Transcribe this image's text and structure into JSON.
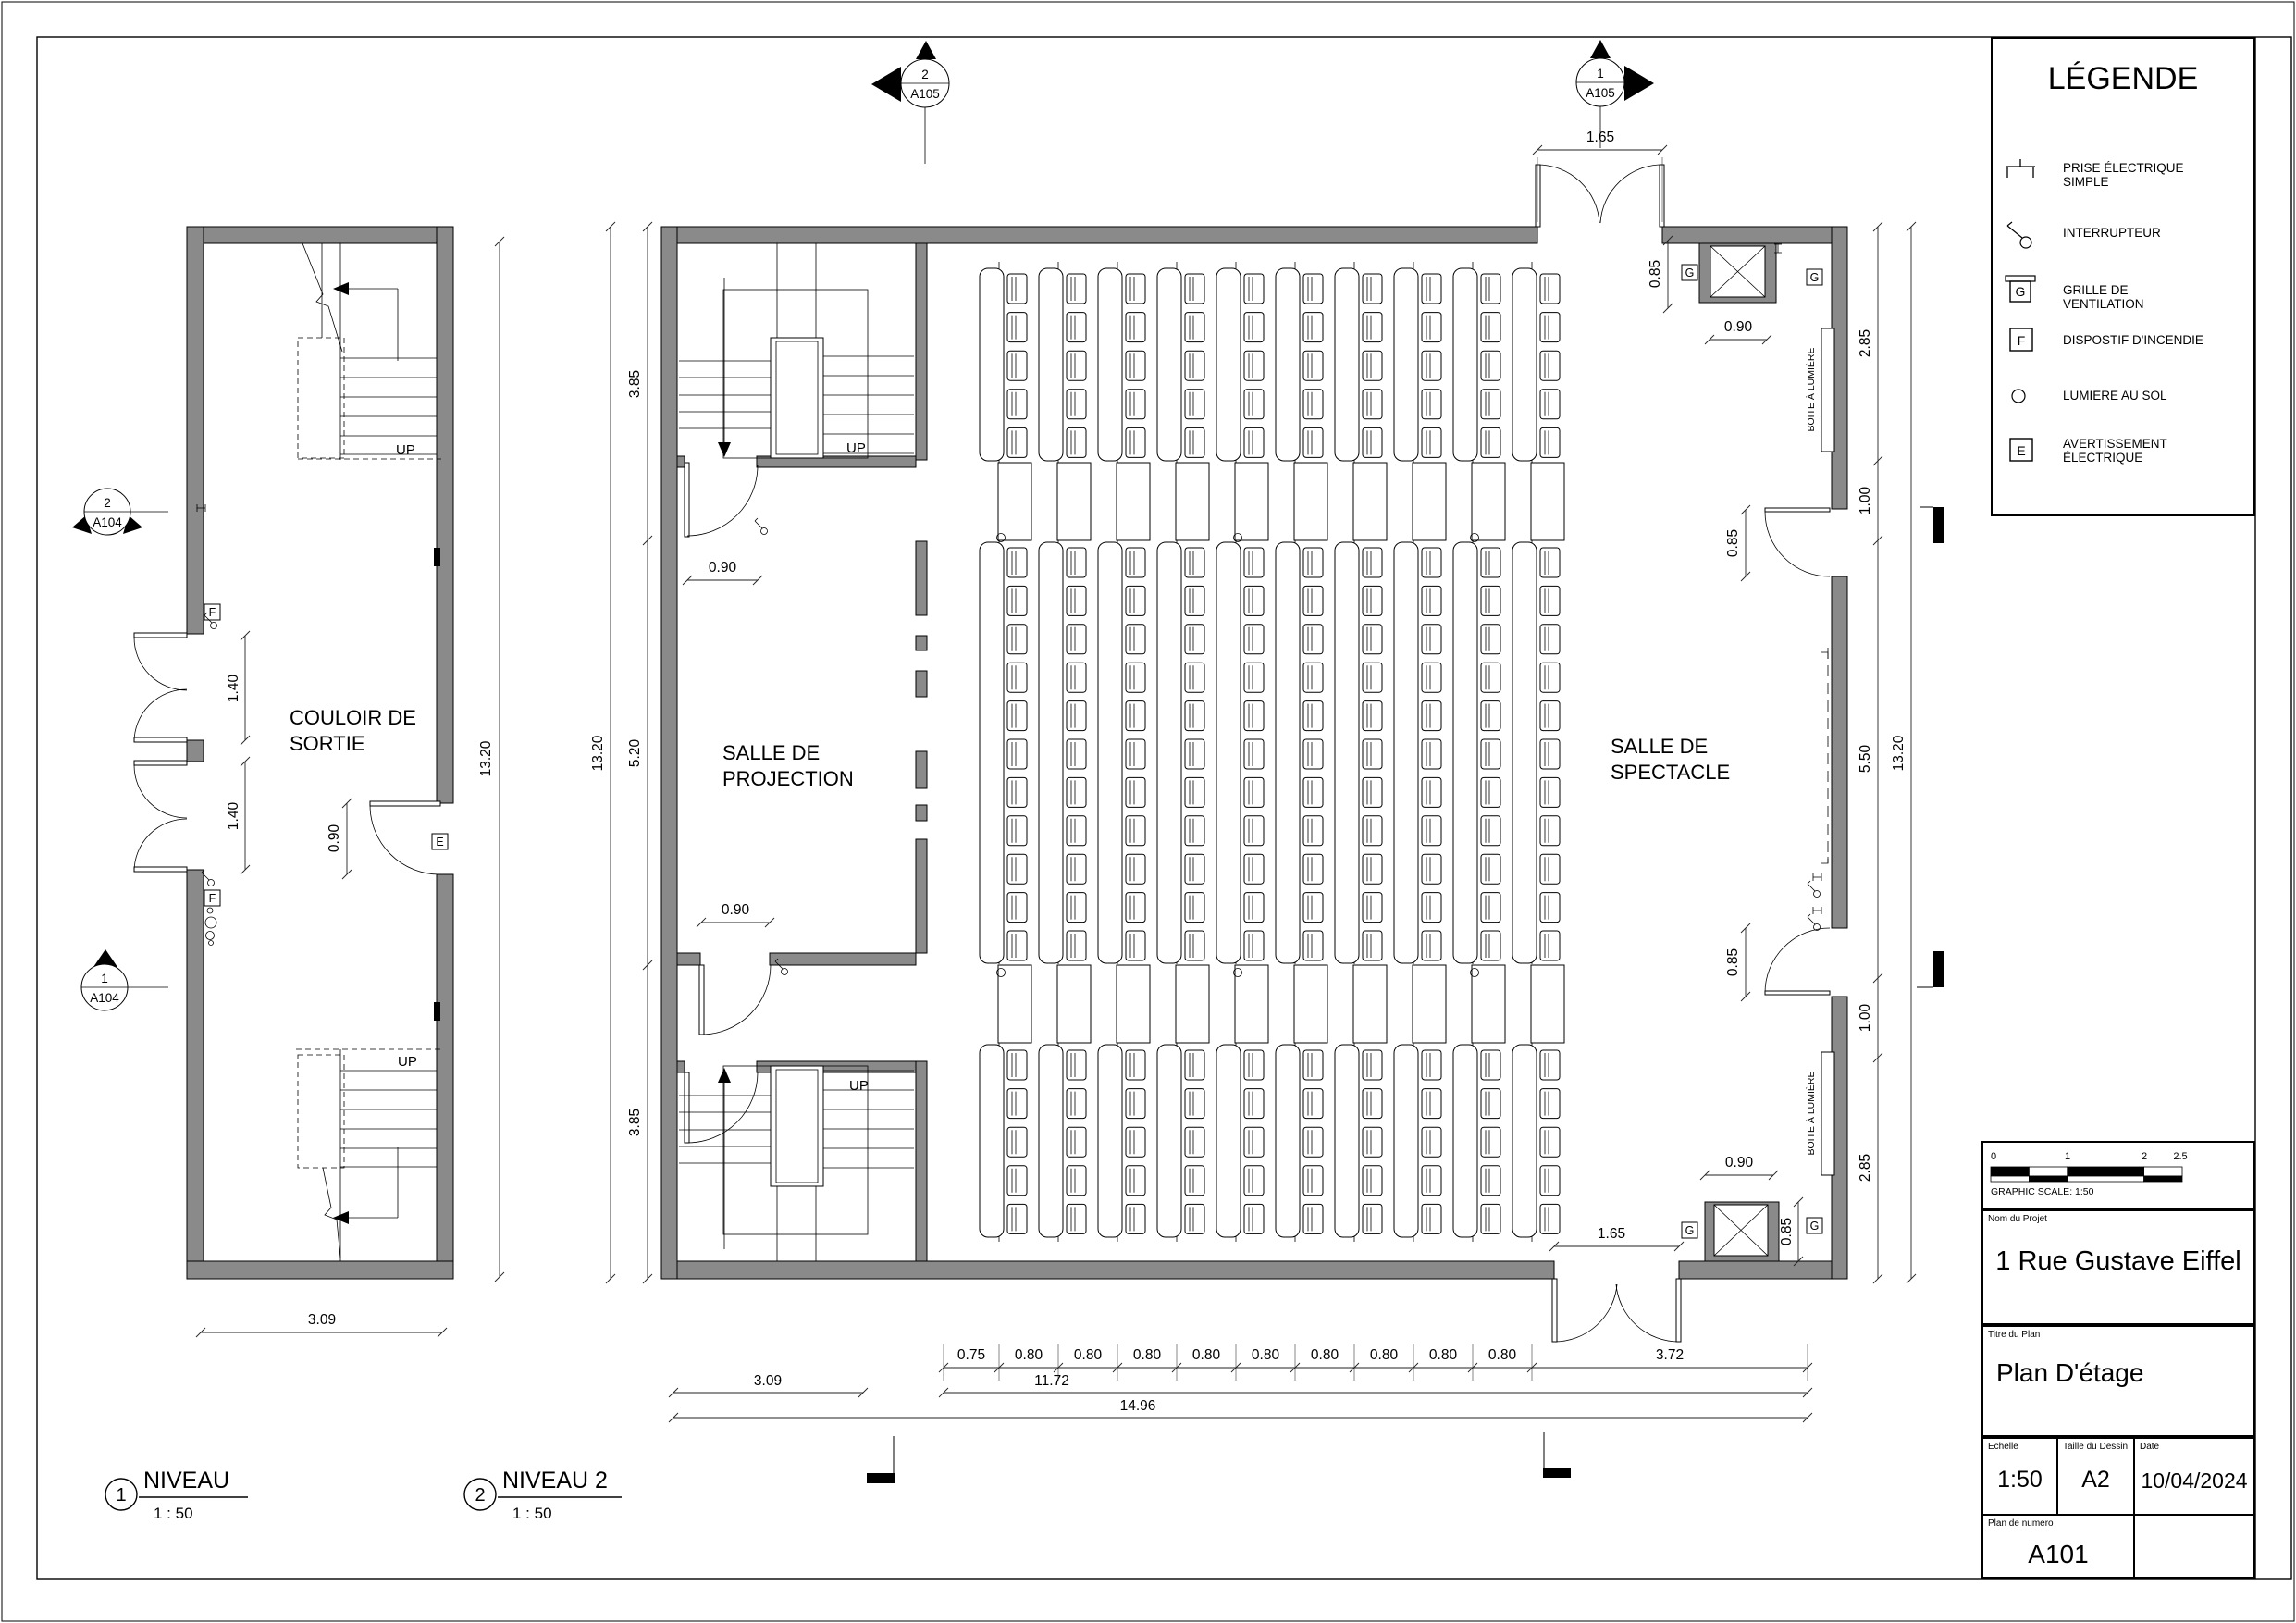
{
  "legend": {
    "title": "LÉGENDE",
    "items": [
      {
        "icon": "outlet-icon",
        "label": "PRISE ÉLECTRIQUE SIMPLE"
      },
      {
        "icon": "switch-icon",
        "label": "INTERRUPTEUR"
      },
      {
        "icon": "vent-grille-icon",
        "letter": "G",
        "label": "GRILLE DE VENTILATION"
      },
      {
        "icon": "fire-device-icon",
        "letter": "F",
        "label": "DISPOSTIF D'INCENDIE"
      },
      {
        "icon": "floor-light-icon",
        "label": "LUMIERE AU SOL"
      },
      {
        "icon": "electric-warning-icon",
        "letter": "E",
        "label": "AVERTISSEMENT ÉLECTRIQUE"
      }
    ]
  },
  "title_block": {
    "scale_bar": {
      "tick_labels": [
        "0",
        "1",
        "2",
        "2.5"
      ],
      "caption": "GRAPHIC SCALE: 1:50"
    },
    "project": {
      "label": "Nom du Projet",
      "value": "1 Rue Gustave Eiffel"
    },
    "plan_title": {
      "label": "Titre du Plan",
      "value": "Plan D'étage"
    },
    "scale": {
      "label": "Echelle",
      "value": "1:50"
    },
    "size": {
      "label": "Taille du Dessin",
      "value": "A2"
    },
    "date": {
      "label": "Date",
      "value": "10/04/2024"
    },
    "number": {
      "label": "Plan de numero",
      "value": "A101"
    }
  },
  "plan1": {
    "title": {
      "num": "1",
      "name": "NIVEAU",
      "scale": "1 : 50"
    },
    "room": [
      "COULOIR DE",
      "SORTIE"
    ],
    "up": "UP",
    "markers": [
      {
        "num": "2",
        "sheet": "A104"
      },
      {
        "num": "1",
        "sheet": "A104"
      }
    ],
    "symbols": {
      "f": "F",
      "e": "E"
    },
    "dims": {
      "door1": "1.40",
      "door2": "1.40",
      "exit": "0.90",
      "height": "13.20",
      "width": "3.09"
    }
  },
  "plan2": {
    "title": {
      "num": "2",
      "name": "NIVEAU 2",
      "scale": "1 : 50"
    },
    "rooms": {
      "projection": [
        "SALLE DE",
        "PROJECTION"
      ],
      "spectacle": [
        "SALLE DE",
        "SPECTACLE"
      ]
    },
    "up": "UP",
    "markers": [
      {
        "num": "2",
        "sheet": "A105"
      },
      {
        "num": "1",
        "sheet": "A105"
      }
    ],
    "g": "G",
    "light_box": "BOITE À LUMIÈRE",
    "dims": {
      "top_door": "1.65",
      "bottom_door": "1.65",
      "stair_door": "0.90",
      "proj_door": "0.90",
      "left1": "3.85",
      "left2": "5.20",
      "left3": "3.85",
      "left_total": "13.20",
      "right1": "2.85",
      "right2": "1.00",
      "right3": "5.50",
      "right4": "1.00",
      "right5": "2.85",
      "right_total": "13.20",
      "vent_top_h": "0.85",
      "vent_top_w": "0.90",
      "doorA": "0.85",
      "doorB": "0.85",
      "vent_bot_w": "0.90",
      "vent_bot_h": "0.85",
      "left_bay": "3.09",
      "mid_total": "11.72",
      "total": "14.96"
    },
    "bottom_chain": [
      "0.75",
      "0.80",
      "0.80",
      "0.80",
      "0.80",
      "0.80",
      "0.80",
      "0.80",
      "0.80",
      "0.80",
      "3.72"
    ]
  }
}
